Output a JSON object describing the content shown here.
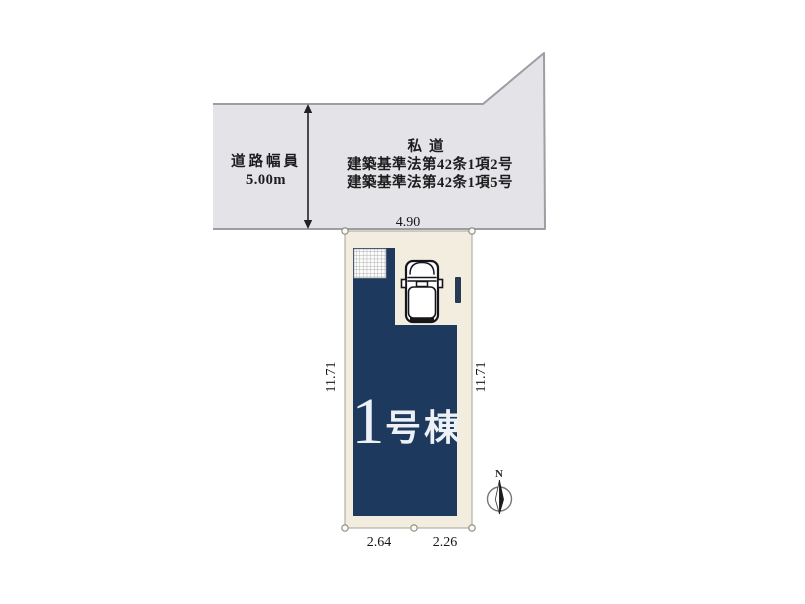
{
  "road": {
    "width_label": "道路幅員",
    "width_value": "5.00m",
    "type_label": "私道",
    "law_line1": "建築基準法第42条1項2号",
    "law_line2": "建築基準法第42条1項5号"
  },
  "plot": {
    "dim_top": "4.90",
    "dim_left": "11.71",
    "dim_right": "11.71",
    "dim_bottom_left": "2.64",
    "dim_bottom_right": "2.26"
  },
  "building": {
    "label_number": "1",
    "label_suffix": "号棟"
  },
  "compass": {
    "north": "N"
  },
  "colors": {
    "road_fill": "#e3e3e8",
    "road_border": "#9d9da3",
    "plot_fill": "#f2edde",
    "plot_border": "#b3b0a4",
    "building": "#1d3a5e",
    "entrance_bar": "#263a54"
  }
}
